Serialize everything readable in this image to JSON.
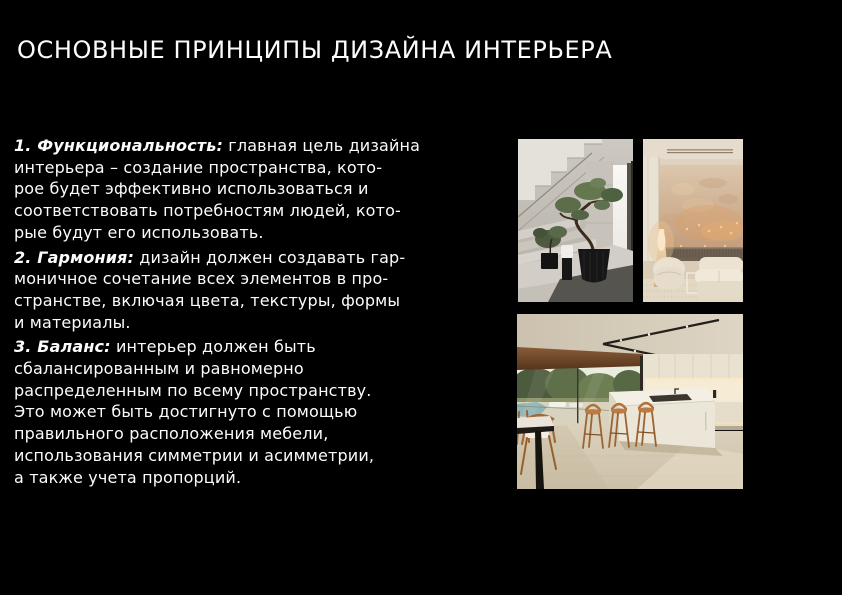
{
  "slide": {
    "title": "ОСНОВНЫЕ ПРИНЦИПЫ ДИЗАЙНА ИНТЕРЬЕРА",
    "colors": {
      "background": "#000000",
      "text": "#ffffff"
    },
    "principles": [
      {
        "lead": "1. Функциональность:",
        "text": " главная цель дизайна\nинтерьера – создание пространства, кото-\nрое будет эффективно использоваться и\nсоответствовать потребностям людей, кото-\nрые будут его использовать."
      },
      {
        "lead": "2. Гармония:",
        "text": " дизайн должен создавать гар-\nмоничное сочетание всех элементов в про-\nстранстве, включая цвета, текстуры, формы\nи материалы."
      },
      {
        "lead": "3. Баланс:",
        "text": " интерьер должен быть\nсбалансированным и равномерно\nраспределенным по всему пространству.\nЭто может быть достигнуто с помощью\nправильного расположения мебели,\nиспользования симметрии и асимметрии,\nа также учета пропорций."
      }
    ],
    "images": [
      {
        "name": "staircase-bonsai",
        "alt": "Светлая каменная лестница с бонсай в чёрном кашпо"
      },
      {
        "name": "beige-living-room",
        "alt": "Бежевая гостиная с фактурной стеной и тёплой подсветкой"
      },
      {
        "name": "minimalist-kitchen",
        "alt": "Минималистичная кухня с белым островом и деревянными барными стульями"
      }
    ]
  }
}
